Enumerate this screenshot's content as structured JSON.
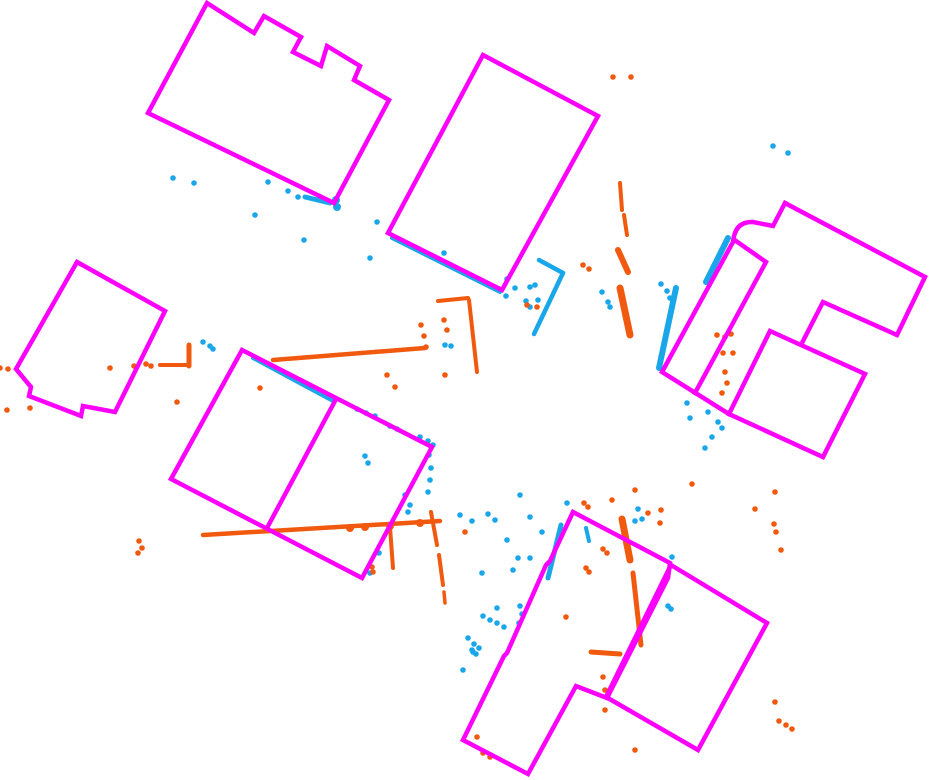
{
  "figure": {
    "width": 931,
    "height": 780,
    "background": "#FFFFFF",
    "colors": {
      "building_outline": "#FB00FB",
      "points_blue": "#19A7EA",
      "points_orange": "#F1590E"
    },
    "outline_stroke_width": 4.5,
    "point_radius": 2.8,
    "buildings": [
      {
        "name": "building-northwest-notched",
        "points": [
          [
            207,
            3
          ],
          [
            254,
            33
          ],
          [
            264,
            16
          ],
          [
            301,
            37
          ],
          [
            293,
            52
          ],
          [
            321,
            66
          ],
          [
            327,
            46
          ],
          [
            360,
            66
          ],
          [
            354,
            80
          ],
          [
            389,
            100
          ],
          [
            334,
            203
          ],
          [
            148,
            113
          ]
        ]
      },
      {
        "name": "building-north-center",
        "points": [
          [
            483,
            55
          ],
          [
            598,
            116
          ],
          [
            502,
            290
          ],
          [
            388,
            233
          ]
        ]
      },
      {
        "name": "building-west-small",
        "points": [
          [
            77,
            262
          ],
          [
            165,
            311
          ],
          [
            115,
            412
          ],
          [
            83,
            406
          ],
          [
            81,
            416
          ],
          [
            29,
            396
          ],
          [
            31,
            387
          ],
          [
            16,
            369
          ]
        ]
      },
      {
        "name": "building-center-west-large",
        "points": [
          [
            242,
            350
          ],
          [
            432,
            447
          ],
          [
            362,
            578
          ],
          [
            171,
            479
          ]
        ]
      },
      {
        "name": "building-south-center",
        "points": [
          [
            573,
            512
          ],
          [
            670,
            563
          ],
          [
            668,
            578
          ],
          [
            607,
            698
          ],
          [
            576,
            686
          ],
          [
            528,
            774
          ],
          [
            463,
            740
          ],
          [
            504,
            656
          ],
          [
            507,
            653
          ],
          [
            546,
            565
          ],
          [
            550,
            561
          ]
        ]
      },
      {
        "name": "building-south-east",
        "points": [
          [
            671,
            565
          ],
          [
            767,
            623
          ],
          [
            698,
            750
          ],
          [
            606,
            697
          ]
        ]
      },
      {
        "name": "building-east-complex-center-block",
        "points": [
          [
            770,
            331
          ],
          [
            865,
            374
          ],
          [
            823,
            457
          ],
          [
            729,
            414
          ]
        ]
      }
    ],
    "building_lines": [
      {
        "name": "building-center-west-partition",
        "points": [
          [
            335,
            401
          ],
          [
            267,
            528
          ]
        ]
      },
      {
        "name": "building-east-complex-upper-outline",
        "points": [
          [
            785,
            203
          ],
          [
            925,
            277
          ],
          [
            897,
            335
          ],
          [
            823,
            302
          ],
          [
            803,
            341
          ]
        ]
      },
      {
        "name": "building-east-complex-partition",
        "points": [
          [
            736,
            241
          ],
          [
            766,
            262
          ],
          [
            695,
            393
          ]
        ]
      }
    ],
    "building_paths": [
      {
        "name": "building-east-complex-rounded-wing",
        "d": "M 785,203 L 773,226 L 753,222 Q 735,221 733,242 L 662,372 L 729,414"
      }
    ],
    "blue_segments": [
      [
        305,
        197,
        330,
        203,
        5
      ],
      [
        392,
        238,
        500,
        292,
        4
      ],
      [
        539,
        260,
        563,
        273,
        4.5
      ],
      [
        563,
        273,
        534,
        334,
        4.5
      ],
      [
        253,
        358,
        333,
        401,
        4
      ],
      [
        728,
        238,
        706,
        282,
        6
      ],
      [
        676,
        288,
        659,
        368,
        6
      ],
      [
        561,
        525,
        548,
        578,
        5
      ],
      [
        586,
        528,
        589,
        541,
        4
      ]
    ],
    "blue_points": [
      [
        173,
        178
      ],
      [
        194,
        183
      ],
      [
        255,
        215
      ],
      [
        268,
        182
      ],
      [
        288,
        191
      ],
      [
        298,
        197
      ],
      [
        304,
        240
      ],
      [
        370,
        258
      ],
      [
        377,
        222
      ],
      [
        336,
        200,
        4
      ],
      [
        337,
        207,
        4
      ],
      [
        444,
        253
      ],
      [
        507,
        279
      ],
      [
        515,
        288
      ],
      [
        506,
        296
      ],
      [
        530,
        287
      ],
      [
        535,
        285
      ],
      [
        526,
        301
      ],
      [
        538,
        300
      ],
      [
        530,
        307
      ],
      [
        445,
        345
      ],
      [
        451,
        346
      ],
      [
        602,
        292
      ],
      [
        608,
        302
      ],
      [
        610,
        307
      ],
      [
        661,
        284
      ],
      [
        667,
        291
      ],
      [
        670,
        298
      ],
      [
        773,
        146
      ],
      [
        788,
        153
      ],
      [
        687,
        403
      ],
      [
        708,
        412
      ],
      [
        718,
        422
      ],
      [
        712,
        437
      ],
      [
        722,
        428
      ],
      [
        705,
        448
      ],
      [
        690,
        418
      ],
      [
        357,
        409
      ],
      [
        366,
        413
      ],
      [
        375,
        416
      ],
      [
        390,
        426
      ],
      [
        397,
        429
      ],
      [
        420,
        437
      ],
      [
        428,
        441
      ],
      [
        433,
        445
      ],
      [
        429,
        455
      ],
      [
        431,
        468
      ],
      [
        430,
        480
      ],
      [
        428,
        492
      ],
      [
        405,
        495
      ],
      [
        410,
        505
      ],
      [
        408,
        512
      ],
      [
        365,
        456
      ],
      [
        368,
        463
      ],
      [
        379,
        553
      ],
      [
        370,
        573
      ],
      [
        203,
        342
      ],
      [
        210,
        346
      ],
      [
        213,
        349
      ],
      [
        460,
        515
      ],
      [
        472,
        521
      ],
      [
        488,
        514
      ],
      [
        495,
        520
      ],
      [
        520,
        495
      ],
      [
        530,
        517
      ],
      [
        507,
        540
      ],
      [
        542,
        532
      ],
      [
        518,
        558
      ],
      [
        530,
        558
      ],
      [
        482,
        573
      ],
      [
        513,
        570
      ],
      [
        567,
        503
      ],
      [
        635,
        521
      ],
      [
        638,
        509
      ],
      [
        642,
        519
      ],
      [
        668,
        606
      ],
      [
        671,
        609
      ],
      [
        672,
        557
      ],
      [
        520,
        606
      ],
      [
        522,
        614
      ],
      [
        519,
        623
      ],
      [
        497,
        608
      ],
      [
        483,
        616
      ],
      [
        490,
        620
      ],
      [
        497,
        623
      ],
      [
        504,
        627
      ],
      [
        468,
        638
      ],
      [
        474,
        644
      ],
      [
        479,
        648
      ],
      [
        473,
        652
      ],
      [
        463,
        670
      ],
      [
        472,
        650
      ],
      [
        476,
        654
      ]
    ],
    "orange_segments": [
      [
        160,
        365,
        188,
        365,
        4
      ],
      [
        189,
        345,
        189,
        366,
        5
      ],
      [
        273,
        360,
        425,
        348,
        4.5
      ],
      [
        203,
        535,
        440,
        521,
        4.5
      ],
      [
        390,
        527,
        393,
        568,
        4
      ],
      [
        431,
        512,
        437,
        545,
        4
      ],
      [
        439,
        555,
        443,
        585,
        4
      ],
      [
        444,
        592,
        445,
        603,
        3.5
      ],
      [
        438,
        301,
        468,
        298,
        4
      ],
      [
        469,
        300,
        477,
        372,
        4
      ],
      [
        620,
        183,
        622,
        210,
        4
      ],
      [
        624,
        215,
        627,
        235,
        4
      ],
      [
        618,
        250,
        628,
        272,
        6
      ],
      [
        620,
        288,
        630,
        335,
        7
      ],
      [
        622,
        519,
        630,
        560,
        7
      ],
      [
        633,
        573,
        641,
        645,
        5
      ],
      [
        591,
        652,
        620,
        654,
        5
      ]
    ],
    "orange_points": [
      [
        0,
        368
      ],
      [
        8,
        369
      ],
      [
        7,
        410
      ],
      [
        30,
        408
      ],
      [
        110,
        368
      ],
      [
        134,
        366
      ],
      [
        146,
        364
      ],
      [
        151,
        366
      ],
      [
        177,
        402
      ],
      [
        260,
        388
      ],
      [
        387,
        375
      ],
      [
        395,
        387
      ],
      [
        139,
        541
      ],
      [
        142,
        548
      ],
      [
        138,
        553
      ],
      [
        350,
        528,
        4
      ],
      [
        365,
        527,
        4
      ],
      [
        390,
        526,
        4
      ],
      [
        420,
        523,
        4
      ],
      [
        372,
        567
      ],
      [
        373,
        572
      ],
      [
        421,
        325
      ],
      [
        424,
        336
      ],
      [
        426,
        347
      ],
      [
        444,
        320
      ],
      [
        447,
        330
      ],
      [
        445,
        375
      ],
      [
        527,
        305
      ],
      [
        537,
        307
      ],
      [
        583,
        265
      ],
      [
        589,
        269
      ],
      [
        613,
        77
      ],
      [
        631,
        77
      ],
      [
        566,
        617
      ],
      [
        465,
        532
      ],
      [
        584,
        503
      ],
      [
        588,
        507
      ],
      [
        612,
        500
      ],
      [
        635,
        490
      ],
      [
        648,
        513
      ],
      [
        661,
        510
      ],
      [
        660,
        523
      ],
      [
        692,
        484
      ],
      [
        603,
        549
      ],
      [
        607,
        553
      ],
      [
        586,
        568
      ],
      [
        589,
        572
      ],
      [
        603,
        677
      ],
      [
        605,
        690
      ],
      [
        605,
        710
      ],
      [
        635,
        750
      ],
      [
        477,
        737
      ],
      [
        483,
        753
      ],
      [
        490,
        757
      ],
      [
        775,
        492
      ],
      [
        755,
        509
      ],
      [
        774,
        524
      ],
      [
        776,
        532
      ],
      [
        781,
        550
      ],
      [
        775,
        702
      ],
      [
        779,
        721
      ],
      [
        786,
        725
      ],
      [
        792,
        729
      ],
      [
        717,
        335
      ],
      [
        725,
        337
      ],
      [
        723,
        353
      ],
      [
        733,
        353
      ],
      [
        725,
        372
      ],
      [
        727,
        383
      ],
      [
        722,
        393
      ],
      [
        731,
        334
      ]
    ]
  }
}
